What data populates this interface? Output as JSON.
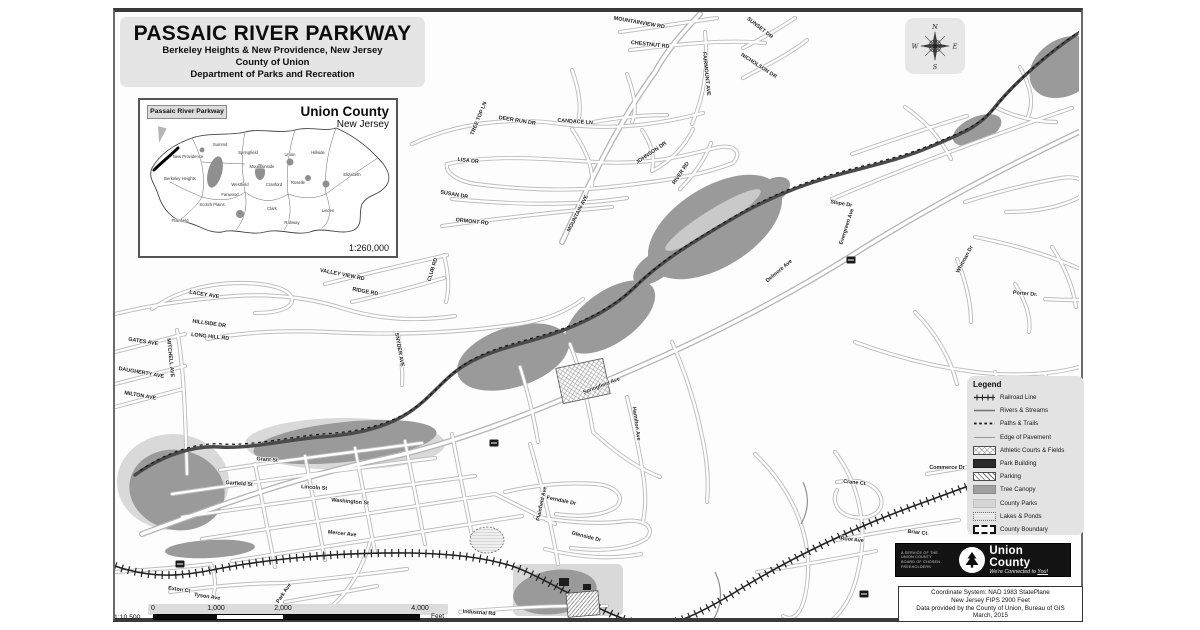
{
  "title_block": {
    "title": "PASSAIC RIVER PARKWAY",
    "subtitle": "Berkeley Heights & New Providence, New Jersey",
    "county": "County of Union",
    "department": "Department of Parks and Recreation"
  },
  "inset_map": {
    "callout": "Passaic River Parkway",
    "title": "Union County",
    "subtitle": "New Jersey",
    "scale": "1:260,000",
    "municipalities": [
      "Summit",
      "New Providence",
      "Berkeley Heights",
      "Springfield",
      "Mountainside",
      "Union",
      "Hillside",
      "Elizabeth",
      "Westfield",
      "Scotch Plains",
      "Fanwood",
      "Plainfield",
      "Cranford",
      "Clark",
      "Rahway",
      "Linden",
      "Roselle"
    ]
  },
  "compass": {
    "north": "N",
    "east": "E",
    "south": "S",
    "west": "W"
  },
  "legend": {
    "title": "Legend",
    "items": [
      {
        "label": "Railroad Line",
        "symbol": "railroad-line"
      },
      {
        "label": "Rivers & Streams",
        "symbol": "river-line"
      },
      {
        "label": "Paths & Trails",
        "symbol": "dashed-trail-line"
      },
      {
        "label": "Edge of Pavement",
        "symbol": "pavement-line"
      },
      {
        "label": "Athletic Courts & Fields",
        "symbol": "crosshatch-swatch"
      },
      {
        "label": "Park Building",
        "symbol": "dark-swatch"
      },
      {
        "label": "Parking",
        "symbol": "diagonal-hatch-swatch"
      },
      {
        "label": "Tree Canopy",
        "symbol": "gray-swatch"
      },
      {
        "label": "County Parks",
        "symbol": "light-gray-swatch"
      },
      {
        "label": "Lakes & Ponds",
        "symbol": "stipple-swatch"
      },
      {
        "label": "County Boundary",
        "symbol": "dashed-outline-swatch"
      }
    ]
  },
  "logo": {
    "service_lines": [
      "A Service of the",
      "Union County",
      "Board of Chosen",
      "Freeholders"
    ],
    "name": "Union County",
    "tagline_prefix": "We're Connected to ",
    "tagline_emphasis": "You!"
  },
  "info_box": {
    "line1": "Coordinate System: NAD 1983 StatePlane",
    "line2": "New Jersey FIPS 2900 Feet",
    "line3": "Data provided by the County of Union, Bureau of GIS",
    "line4": "March, 2015"
  },
  "scale_bar": {
    "ratio": "1:10,500",
    "ticks": [
      "0",
      "1,000",
      "2,000",
      "4,000"
    ],
    "unit": "Feet"
  },
  "map": {
    "colors": {
      "tree_canopy": "#9a9a9a",
      "county_parks": "#d9d9d9",
      "river": "#4a4a4a",
      "road_casing": "#bdbdbd",
      "railroad": "#222222"
    },
    "street_labels": [
      "MOUNTAINVIEW RD",
      "CHESTNUT RD",
      "SUNSET DR",
      "NICHOLSON DR",
      "FAIRMOUNT AVE",
      "TREE TOP LN",
      "DEER RUN DR",
      "CANDACE LN",
      "LISA DR",
      "SUSAN DR",
      "ORMONT RD",
      "JOHNSON DR",
      "RIVER RD",
      "MOUNTAIN AVE",
      "VALLEY VIEW RD",
      "RIDGE RD",
      "CLUB RD",
      "LACEY AVE",
      "HILLSIDE DR",
      "LONG HILL RD",
      "GATES AVE",
      "DAUGHERTY AVE",
      "MILTON AVE",
      "MITCHELL AVE",
      "SNYDER AVE",
      "Grant St",
      "Garfield St",
      "Lincoln St",
      "Washington St",
      "Mercer Ave",
      "Park Ave",
      "Exton Ct",
      "Tyson Ave",
      "Industrial Rd",
      "Springfield Ave",
      "Plainfield Ave",
      "Hamilton Ave",
      "Delmore Ave",
      "Evergreen Ave",
      "Slope Dr",
      "Whitman Dr",
      "Porter Dr.",
      "Commerce Dr",
      "Crane Ct.",
      "Briar Ct.",
      "Root Ave",
      "Ferndale Dr",
      "Glenside Dr"
    ]
  }
}
